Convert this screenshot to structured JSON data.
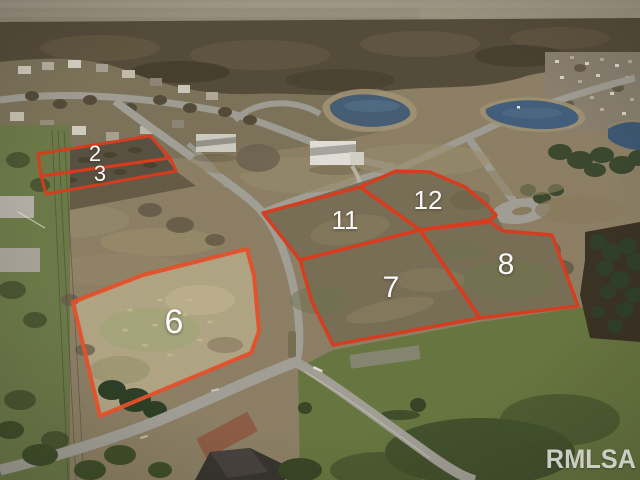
{
  "watermark": {
    "text": "RMLSA"
  },
  "colors": {
    "lot_outline": "#d93b1d",
    "lot6_outline": "#e5502a",
    "lot_number": "#ffffff",
    "watermark": "#d7d7cf"
  },
  "lots": [
    {
      "number": "2",
      "points": "38,154 150,136 170,158 41,176",
      "label_x": 95,
      "label_y": 161,
      "size": 22,
      "stroke_width": 3
    },
    {
      "number": "3",
      "points": "41,176 170,158 176,171 46,194",
      "label_x": 100,
      "label_y": 181,
      "size": 22,
      "stroke_width": 3
    },
    {
      "number": "11",
      "points": "263,213 360,187 420,230 300,260",
      "label_x": 345,
      "label_y": 229,
      "size": 26,
      "stroke_width": 3.5
    },
    {
      "number": "12",
      "points": "360,187 396,171 430,172 465,187 487,205 496,215 490,220 420,230",
      "label_x": 428,
      "label_y": 209,
      "size": 26,
      "stroke_width": 3.5
    },
    {
      "number": "7",
      "points": "300,260 420,230 480,318 333,345 312,302",
      "label_x": 391,
      "label_y": 297,
      "size": 30,
      "stroke_width": 3.5
    },
    {
      "number": "8",
      "points": "420,230 490,222 503,231 552,235 578,306 480,318",
      "label_x": 506,
      "label_y": 274,
      "size": 30,
      "stroke_width": 3.5
    },
    {
      "number": "6",
      "points": "73,302 143,275 247,249 254,276 259,331 251,353 100,416",
      "label_x": 174,
      "label_y": 333,
      "size": 34,
      "stroke_width": 4,
      "stroke": "#e5502a"
    }
  ]
}
